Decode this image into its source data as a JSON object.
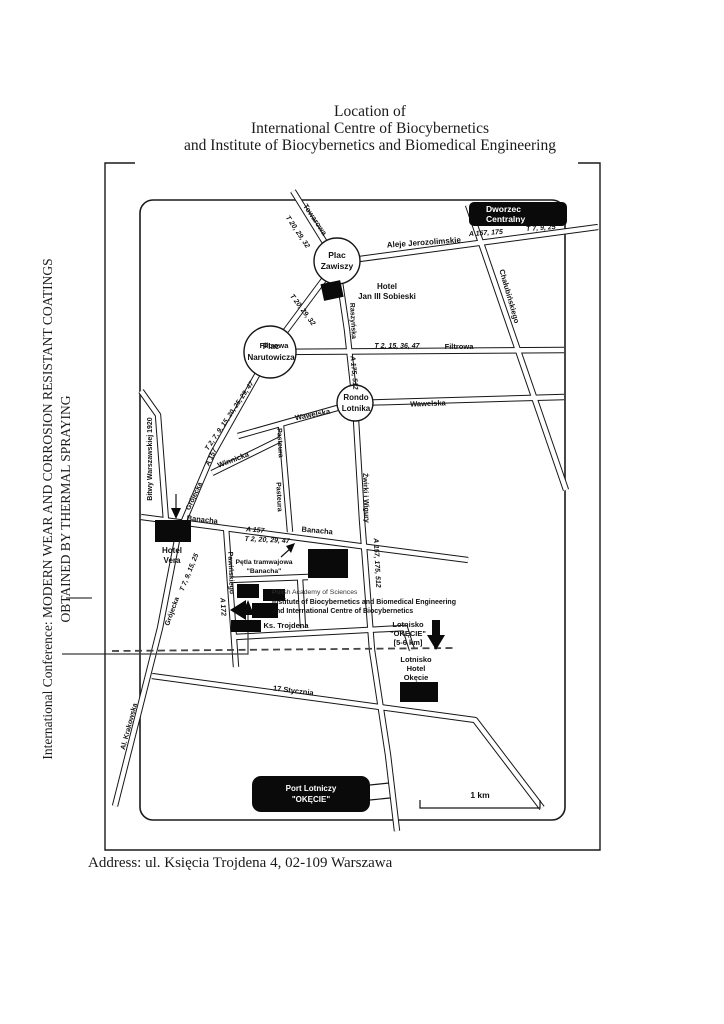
{
  "page": {
    "title_lines": [
      "Location of",
      "International Centre of Biocybernetics",
      "and Institute of Biocybernetics and Biomedical Engineering"
    ],
    "side_note_lines": [
      "International Conference: MODERN WEAR AND CORROSION RESISTANT COATINGS",
      "OBTAINED BY THERMAL SPRAYING"
    ],
    "address": "Address: ul. Księcia Trojdena 4, 02-109 Warszawa"
  },
  "map": {
    "squares": {
      "plac_zawiszy": [
        "Plac",
        "Zawiszy"
      ],
      "plac_narutowicza": [
        "Plac",
        "Narutowicza"
      ],
      "rondo_lotnika": [
        "Rondo",
        "Lotnika"
      ]
    },
    "streets": {
      "towarowa": "Towarowa",
      "aleje_jerozolimskie": "Aleje Jerozolimskie",
      "chalubinskiego": "Chałubińskiego",
      "raszynska": "Raszyńska",
      "filtrowa_west": "Filtrowa",
      "filtrowa_east": "Filtrowa",
      "wawelska_west": "Wawelska",
      "wawelska_east": "Wawelska",
      "winnicka": "Winnicka",
      "pasteura_north": "Pasteura",
      "pasteura_south": "Pasteura",
      "grojecka_upper": "Grójecka",
      "grojecka_lower": "Grójecka",
      "bitwy_warszawskiej": "Bitwy Warszawskiej 1920",
      "zwirki_i_wigury": "Żwirki i Wigury",
      "banacha_west": "Banacha",
      "banacha_east": "Banacha",
      "pawinskiego": "Pawińskiego",
      "ks_trojdena": "Ks. Trojdena",
      "stycznia_17": "17 Stycznia",
      "al_krakowska": "Al. Krakowska"
    },
    "routes": {
      "towarowa_trams": "T 20, 29, 32",
      "zawiszy_narutowicza_trams": "T 20, 29, 32",
      "jerozolimskie_buses": "A 157, 175",
      "jerozolimskie_trams": "T 7, 9, 25",
      "filtrowa_trams": "T 2, 15, 36, 47",
      "raszynska_buses": "A 175, 512",
      "grojecka_upper_trams": "T 2, 7, 9, 15, 20, 25, 29, 47",
      "grojecka_upper_bus": "A 157",
      "grojecka_lower_trams": "T 7, 9, 15, 25",
      "banacha_bus": "A 157",
      "banacha_trams": "T 2, 20, 29, 47",
      "zwirki_buses": "A 157, 175, 512",
      "pawinskiego_bus": "A 172"
    },
    "landmarks": {
      "dworzec_centralny": [
        "Dworzec",
        "Centralny"
      ],
      "hotel_sobieski": [
        "Hotel",
        "Jan III Sobieski"
      ],
      "hotel_vera": [
        "Hotel",
        "Vera"
      ],
      "petla_tramwajowa": [
        "Pętla tramwajowa",
        "\"Banacha\""
      ],
      "academy": [
        "Polish Academy of Sciences",
        "Institute of Biocybernetics and Biomedical Engineering",
        "and International Centre of Biocybernetics"
      ],
      "lotnisko_okecie": [
        "Lotnisko",
        "\"OKĘCIE\"",
        "[5-6 km]"
      ],
      "lotnisko_hotel_okecie": [
        "Lotnisko",
        "Hotel",
        "Okęcie"
      ],
      "port_lotniczy": [
        "Port Lotniczy",
        "\"OKĘCIE\""
      ]
    },
    "scale_label": "1 km"
  },
  "colors": {
    "ink": "#111111",
    "paper": "#ffffff"
  }
}
